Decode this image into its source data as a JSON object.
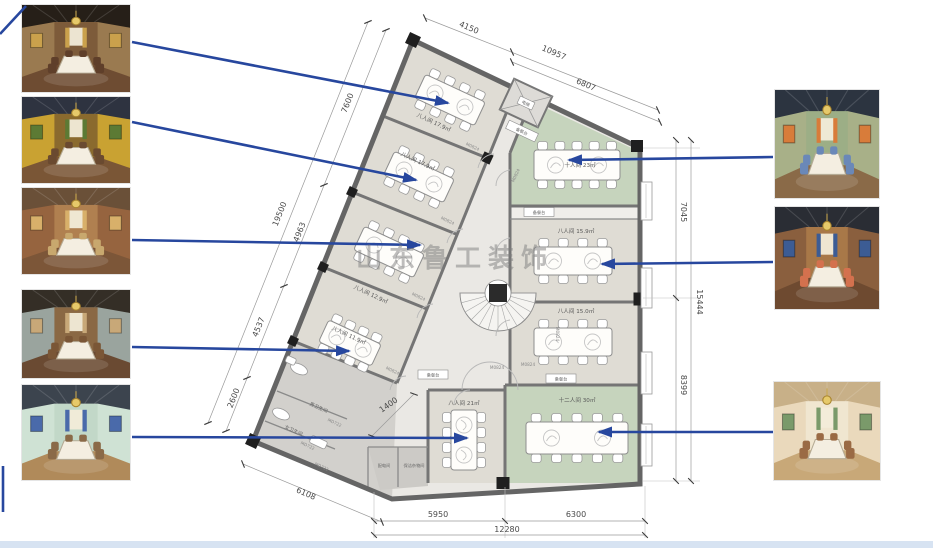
{
  "watermark": "山东鲁工装饰",
  "rooms": {
    "left_wing": [
      {
        "label": "八人间 17.9㎡"
      },
      {
        "label": "八人间 17.9㎡"
      },
      {
        "label": "八人间 12.9㎡"
      },
      {
        "label": "八人间 11.9㎡"
      }
    ],
    "bottom": {
      "label": "八人间 21㎡"
    },
    "right_wing": [
      {
        "label": "十人间 23㎡"
      },
      {
        "label": "八人间 15.9㎡"
      },
      {
        "label": "八人间 15.0㎡"
      },
      {
        "label": "十二人间 30㎡"
      }
    ],
    "service": {
      "male_wc": "男卫生间",
      "female_wc": "女卫生间",
      "power": "配电间",
      "cleaning": "保洁杂物间",
      "elevator": "电梯",
      "serving": "备餐台"
    }
  },
  "door_tags": {
    "m0824": "M0824",
    "md722": "MD722"
  },
  "dimensions": {
    "top": [
      "4150",
      "10957",
      "6807"
    ],
    "left": [
      "7600",
      "19500",
      "4963",
      "4537",
      "2600"
    ],
    "bottom_left": "6108",
    "corridor": "1400",
    "right": [
      "7045",
      "15444",
      "8399"
    ],
    "bottom": [
      "5950",
      "6300",
      "12280"
    ]
  },
  "colors": {
    "arrow": "#27479e",
    "room_fill": "#dfdcd4",
    "green_room": "#c6d4bd",
    "corridor": "#eae8e4",
    "wall": "#656565",
    "watermark_gray": "#7d7d7d"
  },
  "photos": {
    "left": [
      {
        "desc": "wood-paneled private dining room with chandelier and wall paintings",
        "ceiling": "#261f18",
        "wall": "#9a7a50",
        "back": "#7d5b3a",
        "floor": "#6e4c32",
        "accent": "#caa14c",
        "chair": "#5f3f2a"
      },
      {
        "desc": "private dining room with golden tree mural and green trim",
        "ceiling": "#2e3340",
        "wall": "#c9a232",
        "back": "#8a6a2e",
        "floor": "#7a5636",
        "accent": "#5c7a34",
        "chair": "#6a4a30"
      },
      {
        "desc": "brick and wood dining room with arched alcove",
        "ceiling": "#6a5038",
        "wall": "#96643f",
        "back": "#b08050",
        "floor": "#7c5638",
        "accent": "#d8b06a",
        "chair": "#c8a86e"
      },
      {
        "desc": "dark wood dining room with long banquet table",
        "ceiling": "#342e26",
        "wall": "#9aa49e",
        "back": "#8a6844",
        "floor": "#6a4a32",
        "accent": "#c8a878",
        "chair": "#7a5636"
      },
      {
        "desc": "mint green dining room with paintings and wood floor",
        "ceiling": "#3c444e",
        "wall": "#cfe2d4",
        "back": "#c2d8c8",
        "floor": "#b08a5a",
        "accent": "#4a6aaa",
        "chair": "#8a6a48"
      }
    ],
    "right": [
      {
        "desc": "dining room with blue chairs, brick wall and ceiling wreath",
        "ceiling": "#2c3440",
        "wall": "#a8b088",
        "back": "#9cae86",
        "floor": "#8a6a48",
        "accent": "#d87c3a",
        "chair": "#6a88b8"
      },
      {
        "desc": "dining room with coral chairs, blue curtains and barrel wall",
        "ceiling": "#2a2d34",
        "wall": "#8a5f3e",
        "back": "#a87848",
        "floor": "#6e4a30",
        "accent": "#3c5c94",
        "chair": "#d4714e"
      },
      {
        "desc": "bright classical dining room with painted ceiling mural",
        "ceiling": "#c8b088",
        "wall": "#ead9bc",
        "back": "#f0e6d0",
        "floor": "#c8a878",
        "accent": "#7a9a6a",
        "chair": "#9a6a44"
      }
    ]
  }
}
